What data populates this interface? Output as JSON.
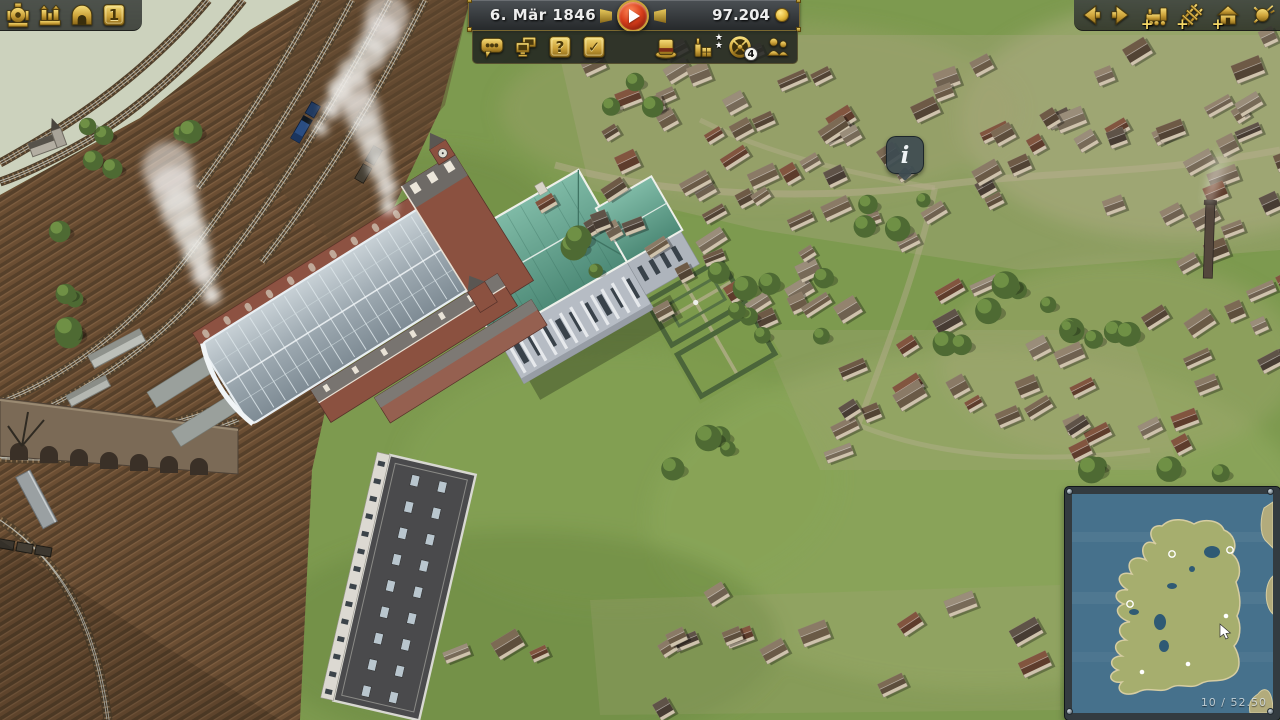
{
  "hud": {
    "top_left_toolbar": {
      "items": [
        {
          "icon": "locomotive-icon",
          "name": "locomotives-menu"
        },
        {
          "icon": "station-icon",
          "name": "stations-menu"
        },
        {
          "icon": "roundhouse-icon",
          "name": "depots-menu"
        },
        {
          "icon": "speed-plate-icon",
          "name": "game-speed",
          "label": "1"
        }
      ]
    },
    "status_panel": {
      "date": "6. Mär 1846",
      "money": "97.204",
      "coin_icon": "coin-icon",
      "play_icon": "play-icon"
    },
    "sub_toolbar": {
      "left": [
        {
          "icon": "chat-dots-icon"
        },
        {
          "icon": "screens-icon"
        },
        {
          "icon": "question-icon",
          "label": "?"
        },
        {
          "icon": "task-check-icon",
          "label": "✓"
        }
      ],
      "right": [
        {
          "icon": "top-hat-icon"
        },
        {
          "icon": "goods-stars-icon",
          "stars": [
            "★",
            "★"
          ]
        },
        {
          "icon": "wheel-gauge-icon",
          "badge": "4"
        },
        {
          "icon": "staff-icon"
        }
      ]
    },
    "top_right_toolbar": {
      "items": [
        {
          "icon": "arrow-left-icon"
        },
        {
          "icon": "arrow-right-icon"
        },
        {
          "icon": "buy-locomotive-icon",
          "badge": "+"
        },
        {
          "icon": "lay-track-icon",
          "badge": "+"
        },
        {
          "icon": "build-station-icon",
          "badge": "+"
        },
        {
          "icon": "demolish-icon"
        }
      ]
    },
    "info_marker": {
      "label": "i"
    },
    "minimap": {
      "scale_text": "10 / 52.50"
    }
  },
  "colors": {
    "gold": "#d9b44a",
    "panel_dark": "#2d312f",
    "play_red": "#d93f1c",
    "minimap_sea": "#46718c",
    "minimap_land": "#a6ae6e",
    "grass": "#7d9a4f",
    "field": "#6b4e33",
    "mansion_roof": "#5f9e8c"
  }
}
